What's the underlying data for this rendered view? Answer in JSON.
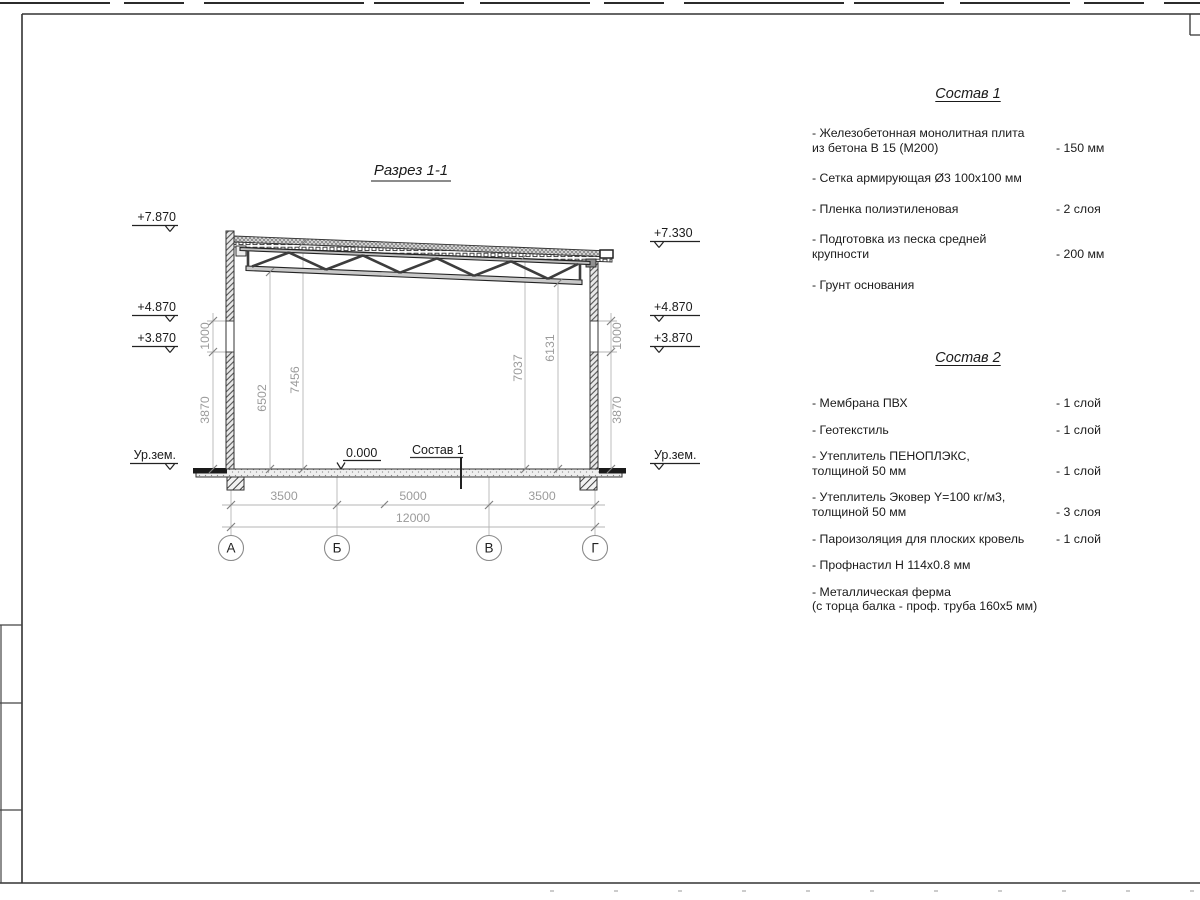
{
  "sheet": {
    "section_title": "Разрез 1-1"
  },
  "section": {
    "elev_left": [
      "+7.870",
      "+4.870",
      "+3.870",
      "Ур.зем."
    ],
    "elev_right": [
      "+7.330",
      "+4.870",
      "+3.870",
      "Ур.зем."
    ],
    "zero_mark": "0.000",
    "floor_ref_label": "Состав 1",
    "inner_dims": [
      "6502",
      "7456",
      "7037",
      "6131"
    ],
    "side_dims_left": [
      "1000",
      "3870"
    ],
    "side_dims_right": [
      "1000",
      "3870"
    ],
    "bottom_dims": [
      "3500",
      "5000",
      "3500"
    ],
    "overall_dim": "12000",
    "axes": [
      "А",
      "Б",
      "В",
      "Г"
    ]
  },
  "composition1": {
    "title": "Состав 1",
    "items": [
      {
        "text": "- Железобетонная  монолитная плита\nиз бетона В 15 (М200)",
        "value": "- 150 мм"
      },
      {
        "text": "- Сетка армирующая Ø3 100x100 мм",
        "value": ""
      },
      {
        "text": "- Пленка полиэтиленовая",
        "value": "-  2 слоя"
      },
      {
        "text": "- Подготовка из песка средней\nкрупности",
        "value": "- 200 мм"
      },
      {
        "text": "- Грунт основания",
        "value": ""
      }
    ]
  },
  "composition2": {
    "title": "Состав 2",
    "items": [
      {
        "text": "- Мембрана ПВХ",
        "value": "- 1 слой"
      },
      {
        "text": "- Геотекстиль",
        "value": "- 1 слой"
      },
      {
        "text": "- Утеплитель ПЕНОПЛЭКС,\nтолщиной 50 мм",
        "value": "- 1 слой"
      },
      {
        "text": "- Утеплитель Эковер Y=100 кг/м3,\nтолщиной 50 мм",
        "value": "- 3 слоя"
      },
      {
        "text": "- Пароизоляция для плоских кровель",
        "value": "- 1 слой"
      },
      {
        "text": "- Профнастил Н 114x0.8 мм",
        "value": ""
      },
      {
        "text": "- Металлическая ферма\n(с торца балка - проф. труба 160x5 мм)",
        "value": ""
      }
    ]
  },
  "colors": {
    "line": "#333333",
    "dim_gray": "#9b9b9b",
    "text": "#1a1a1a"
  }
}
